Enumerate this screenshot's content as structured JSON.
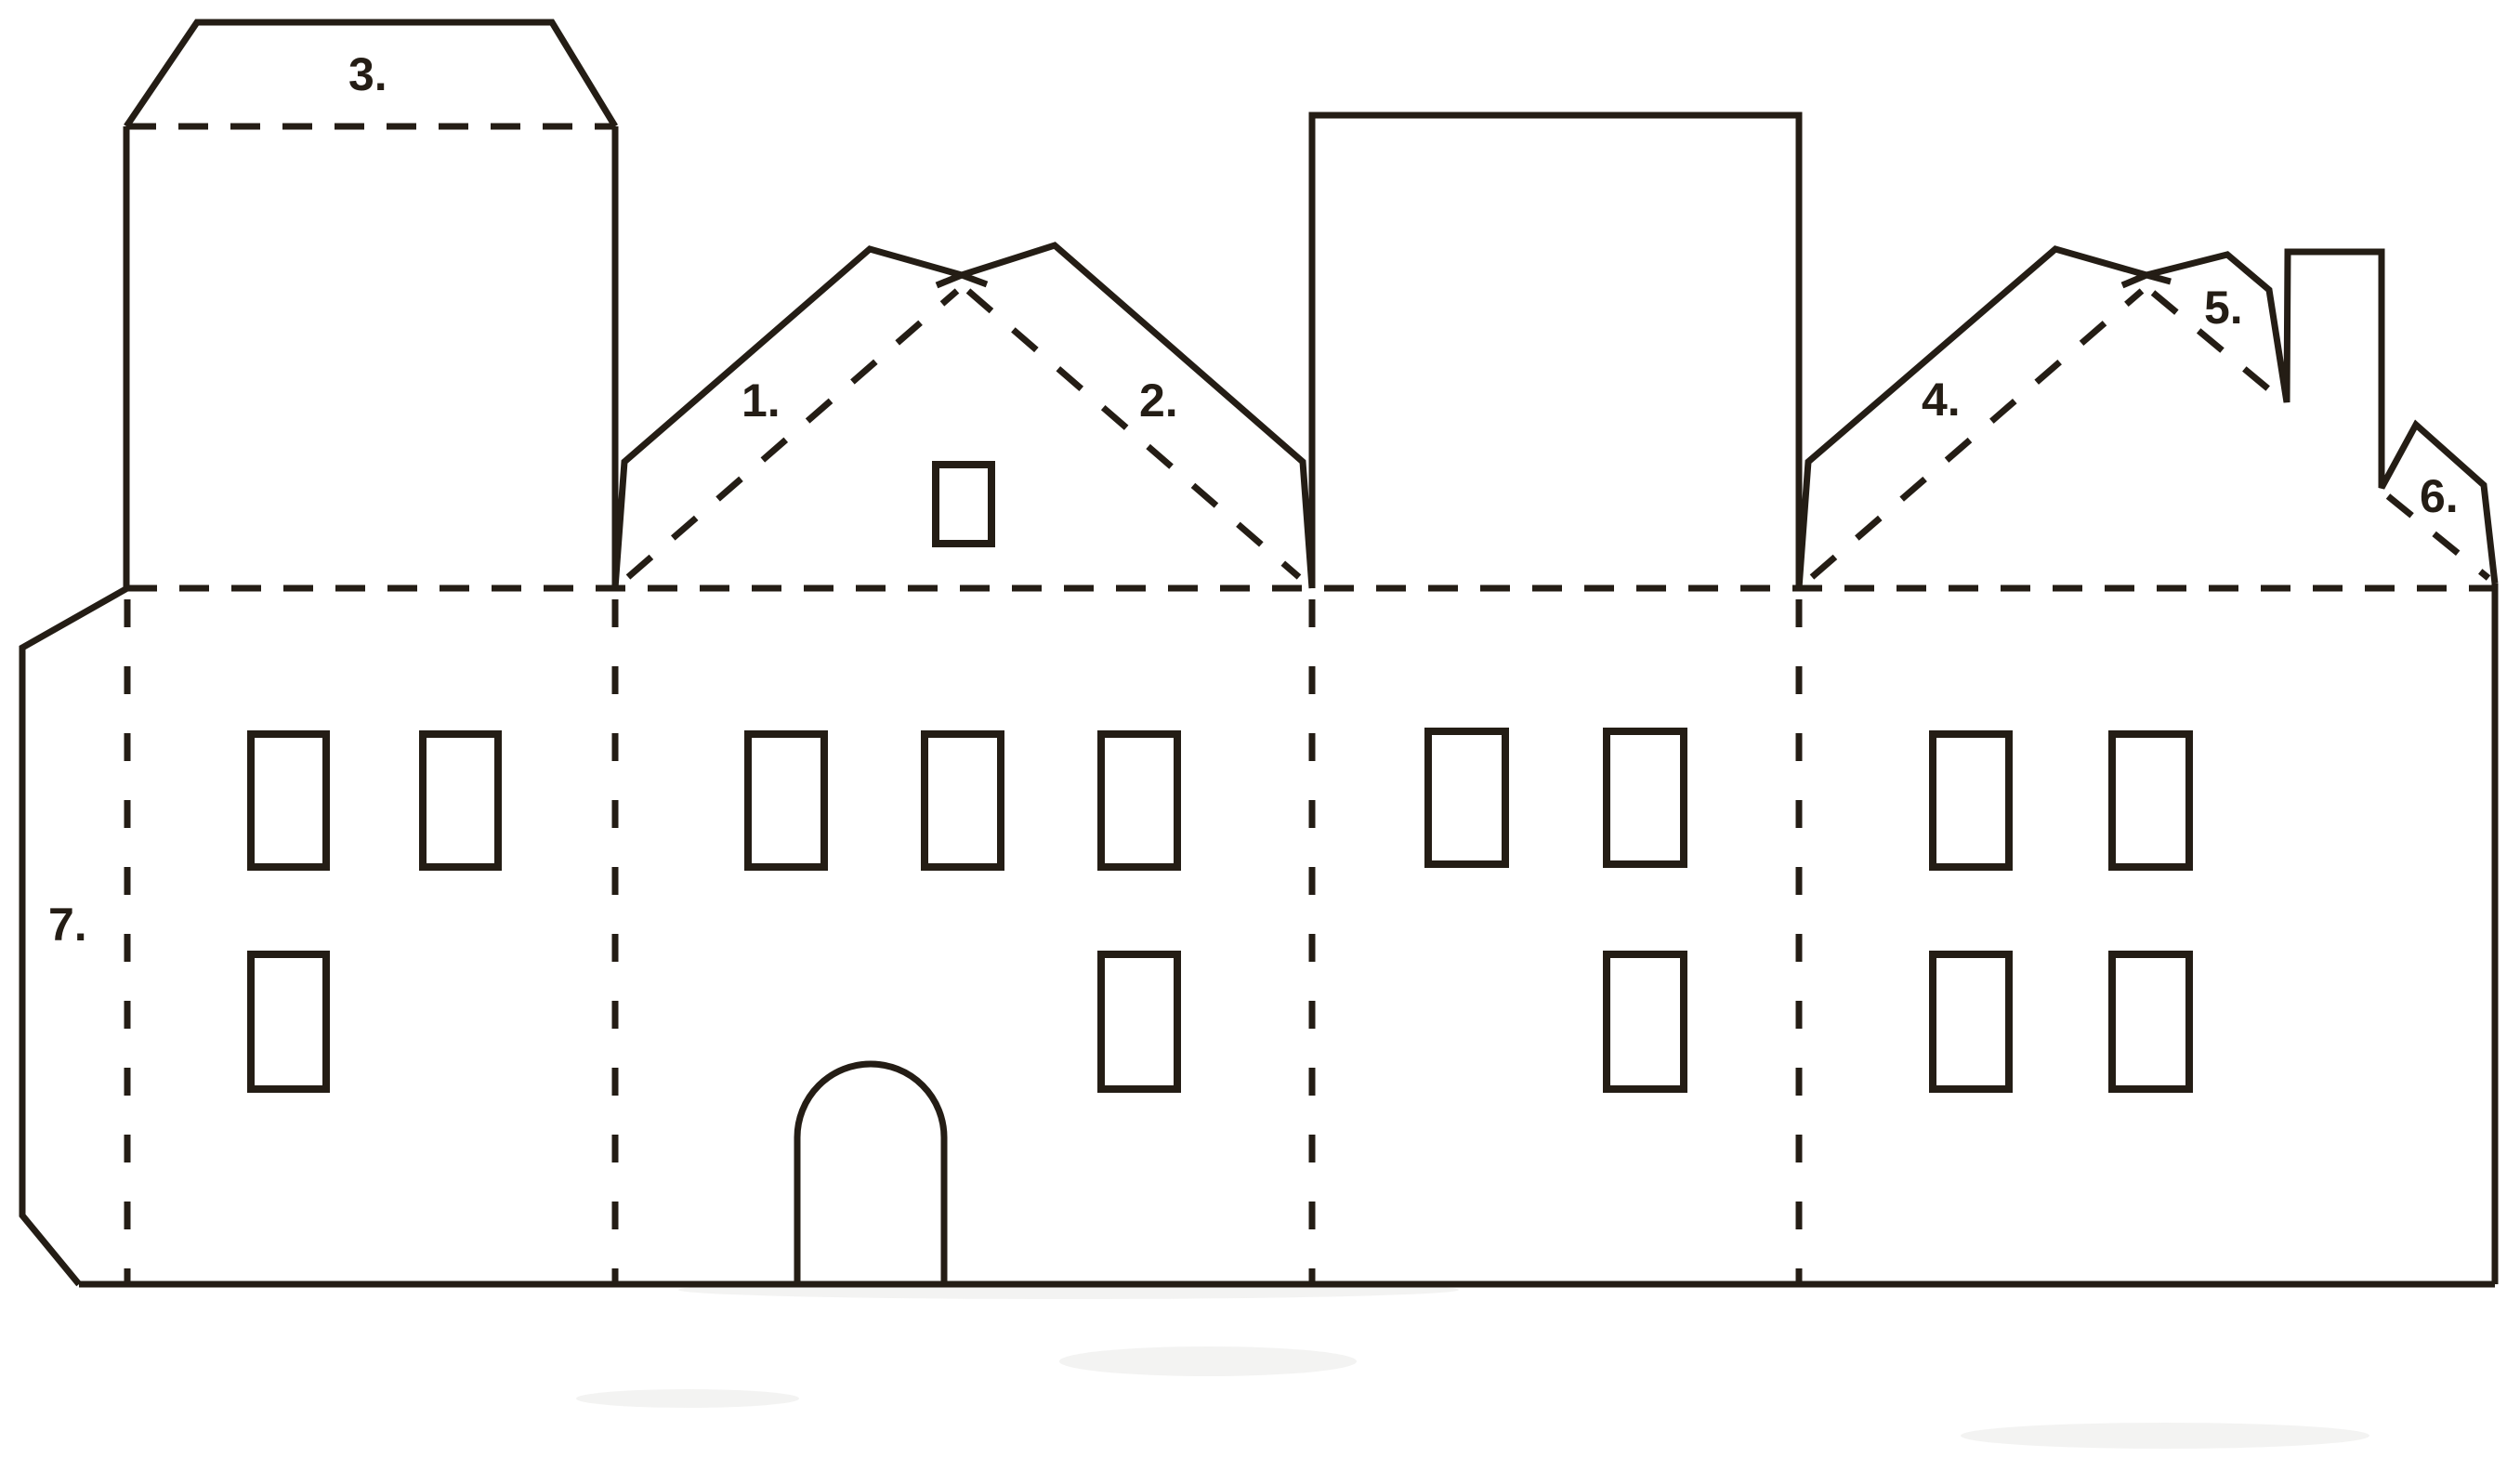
{
  "diagram": {
    "type": "papercraft-house-template",
    "numbered_tabs_total": 7
  },
  "colors": {
    "line": "#241d15",
    "background": "#ffffff"
  },
  "labels": [
    {
      "id": 1,
      "text": "1."
    },
    {
      "id": 2,
      "text": "2."
    },
    {
      "id": 3,
      "text": "3."
    },
    {
      "id": 4,
      "text": "4."
    },
    {
      "id": 5,
      "text": "5."
    },
    {
      "id": 6,
      "text": "6."
    },
    {
      "id": 7,
      "text": "7."
    }
  ],
  "sections": [
    {
      "name": "side-wall-with-tower",
      "upper_windows": 2,
      "lower_windows": 1
    },
    {
      "name": "gabled-front-wall-with-door",
      "upper_windows": 3,
      "lower_windows": 1,
      "gable_windows": 1,
      "doors": 1
    },
    {
      "name": "side-wall-with-roof-tab",
      "upper_windows": 2,
      "lower_windows": 1
    },
    {
      "name": "gabled-front-wall-with-chimney",
      "upper_windows": 2,
      "lower_windows": 2
    }
  ]
}
